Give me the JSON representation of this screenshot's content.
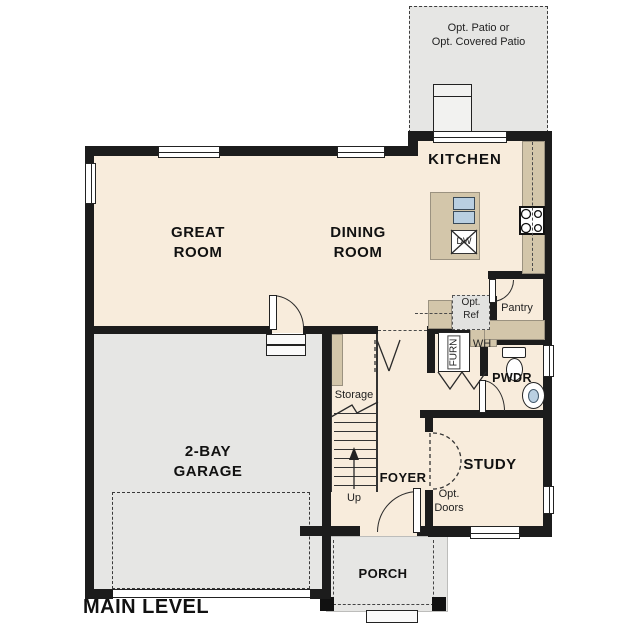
{
  "plan": {
    "title": "MAIN LEVEL",
    "rooms": {
      "great_room": "GREAT\nROOM",
      "dining_room": "DINING\nROOM",
      "kitchen": "KITCHEN",
      "garage": "2-BAY\nGARAGE",
      "study": "STUDY",
      "foyer": "FOYER",
      "porch": "PORCH",
      "powder": "PWDR",
      "pantry": "Pantry",
      "storage": "Storage"
    },
    "annotations": {
      "patio": "Opt. Patio or\nOpt. Covered Patio",
      "opt_ref": "Opt.\nRef",
      "opt_doors": "Opt.\nDoors",
      "water_heater": "WH",
      "furnace": "FURN",
      "dishwasher": "DW",
      "stairs_up": "Up"
    },
    "colors": {
      "interior_floor": "#f8ecdc",
      "exterior_concrete": "#e6e6e4",
      "cabinet_tan": "#d3c6aa",
      "wall": "#1c1c1c",
      "fixture_blue": "#b9cfe1"
    }
  }
}
